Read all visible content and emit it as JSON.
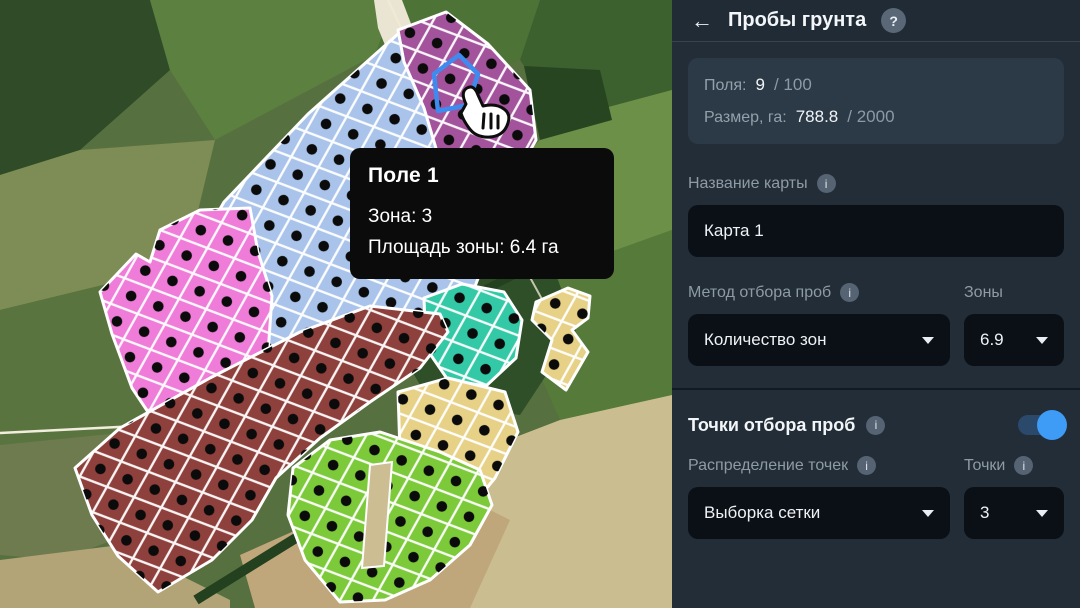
{
  "map": {
    "tooltip": {
      "title": "Поле 1",
      "zone_line": "Зона: 3",
      "area_line": "Площадь зоны: 6.4 га"
    },
    "highlight_color": "#3E8BF0",
    "dot_color": "#0b0b0b",
    "cell_border_color": "#ffffff",
    "zones": [
      {
        "name": "blue",
        "color": "#A9C3EA",
        "points": "150,332 224,202 308,114 398,34 432,58 452,132 472,210 482,268 466,310 420,332 340,348 260,345 200,342"
      },
      {
        "name": "purple",
        "color": "#A2539C",
        "points": "398,30 446,12 488,44 530,90 536,140 510,186 526,224 494,256 464,240 446,182 424,108 404,62"
      },
      {
        "name": "pink",
        "color": "#EE7CD8",
        "points": "100,292 136,254 150,262 160,230 200,210 250,208 258,252 272,296 268,354 246,414 206,448 164,436 132,388 112,334"
      },
      {
        "name": "teal",
        "color": "#33C9A6",
        "points": "424,298 462,284 504,292 522,320 516,358 486,386 448,380 426,348"
      },
      {
        "name": "maroon",
        "color": "#8E403C",
        "points": "75,468 120,428 210,378 300,332 370,306 440,314 448,332 420,368 370,402 320,438 276,478 252,520 212,560 158,592 118,556 92,515"
      },
      {
        "name": "yellow-north",
        "color": "#E6D187",
        "points": "536,302 568,288 590,296 588,318 572,330 588,352 566,390 542,372 552,340 532,320"
      },
      {
        "name": "yellow-south",
        "color": "#E6D187",
        "points": "398,392 448,378 505,392 518,432 495,478 462,518 424,500 400,452"
      },
      {
        "name": "green",
        "color": "#7CC93A",
        "points": "293,468 330,440 380,432 440,452 480,470 492,505 470,545 430,580 385,600 340,602 305,560 288,515"
      }
    ]
  },
  "panel": {
    "icons": {
      "info": "i"
    },
    "header": {
      "back_icon": "←",
      "title": "Пробы грунта",
      "help_icon": "?"
    },
    "stats": {
      "fields_label": "Поля:",
      "fields_value": "9",
      "fields_total": "/ 100",
      "size_label": "Размер, га:",
      "size_value": "788.8",
      "size_total": "/ 2000"
    },
    "map_name": {
      "label": "Название карты",
      "value": "Карта 1"
    },
    "method": {
      "label": "Метод отбора проб",
      "value": "Количество зон"
    },
    "zones_select": {
      "label": "Зоны",
      "value": "6.9"
    },
    "points_section": {
      "label": "Точки отбора проб",
      "enabled": true
    },
    "distribution": {
      "label": "Распределение точек",
      "value": "Выборка сетки"
    },
    "points_select": {
      "label": "Точки",
      "value": "3"
    }
  }
}
